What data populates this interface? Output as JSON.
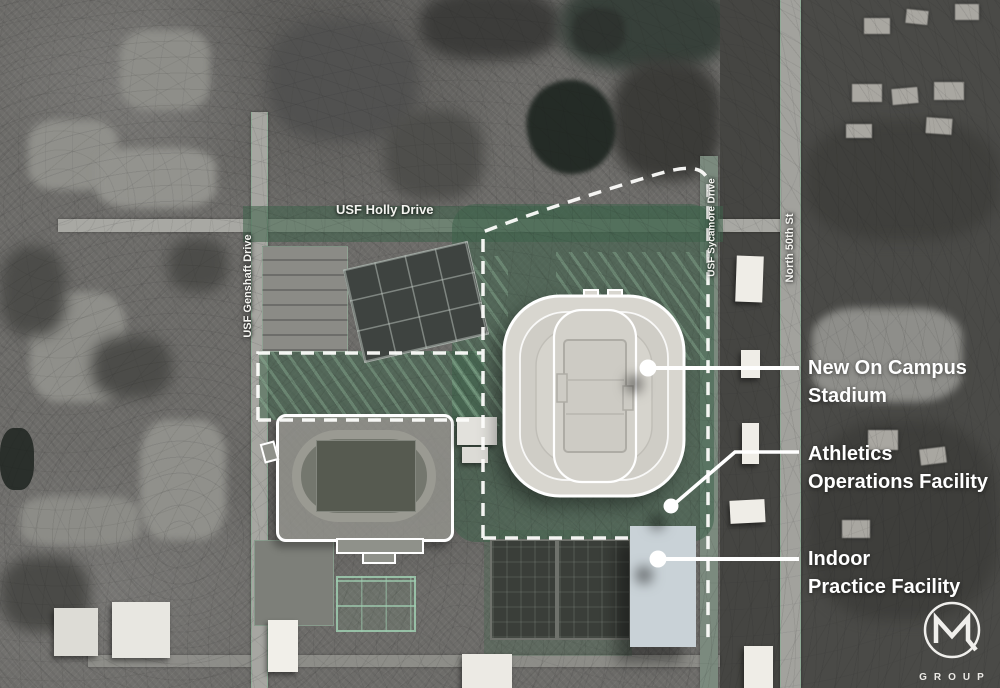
{
  "streets": [
    {
      "name": "USF Holly Drive"
    },
    {
      "name": "USF Genshaft Drive"
    },
    {
      "name": "USF Sycamore Drive"
    },
    {
      "name": "North 50th St"
    }
  ],
  "callouts": [
    {
      "line1": "New On Campus",
      "line2": "Stadium"
    },
    {
      "line1": "Athletics",
      "line2": "Operations Facility"
    },
    {
      "line1": "Indoor",
      "line2": "Practice Facility"
    }
  ],
  "logo": {
    "text": "GROUP"
  },
  "colors": {
    "site_green": "#3e624a",
    "stadium_fill": "#d8d6cf",
    "indoor_facility_fill": "#c9d2d7",
    "boundary_dash": "#fdfdfb",
    "callout_white": "#ffffff"
  }
}
